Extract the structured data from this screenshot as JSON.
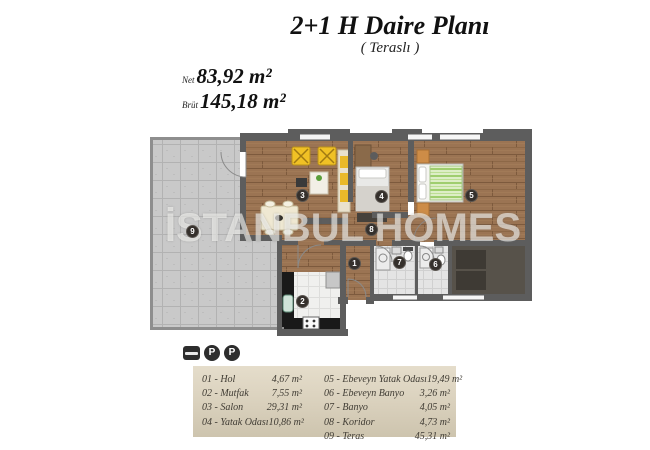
{
  "header": {
    "title": "2+1 H Daire Planı",
    "subtitle": "( Teraslı )",
    "net_label": "Net",
    "net_value": "83,92 m²",
    "brut_label": "Brüt",
    "brut_value": "145,18 m²"
  },
  "watermark": "İSTANBUL HOMES",
  "legend_icons": {
    "parking": "P"
  },
  "legend": {
    "left": [
      {
        "label": "01 - Hol",
        "value": "4,67 m²"
      },
      {
        "label": "02 - Mutfak",
        "value": "7,55 m²"
      },
      {
        "label": "03 - Salon",
        "value": "29,31 m²"
      },
      {
        "label": "04 - Yatak Odası",
        "value": "10,86 m²"
      }
    ],
    "right": [
      {
        "label": "05 - Ebeveyn Yatak Odası",
        "value": "19,49 m²"
      },
      {
        "label": "06 - Ebeveyn Banyo",
        "value": "3,26 m²"
      },
      {
        "label": "07 - Banyo",
        "value": "4,05 m²"
      },
      {
        "label": "08 - Koridor",
        "value": "4,73 m²"
      },
      {
        "label": "09 - Teras",
        "value": "45,31 m²"
      }
    ]
  },
  "plan": {
    "markers": [
      {
        "num": "1"
      },
      {
        "num": "2"
      },
      {
        "num": "3"
      },
      {
        "num": "4"
      },
      {
        "num": "5"
      },
      {
        "num": "6"
      },
      {
        "num": "7"
      },
      {
        "num": "8"
      },
      {
        "num": "9"
      }
    ]
  },
  "colors": {
    "wall": "#5d5d5d",
    "terrace_rail": "#8e8e8e",
    "wood": "#9b7453",
    "terrace_tile": "#c9c9c9",
    "accent_yellow": "#f0c125",
    "legend_bg": "#d9d0bc",
    "marker_bg": "#35302c"
  }
}
